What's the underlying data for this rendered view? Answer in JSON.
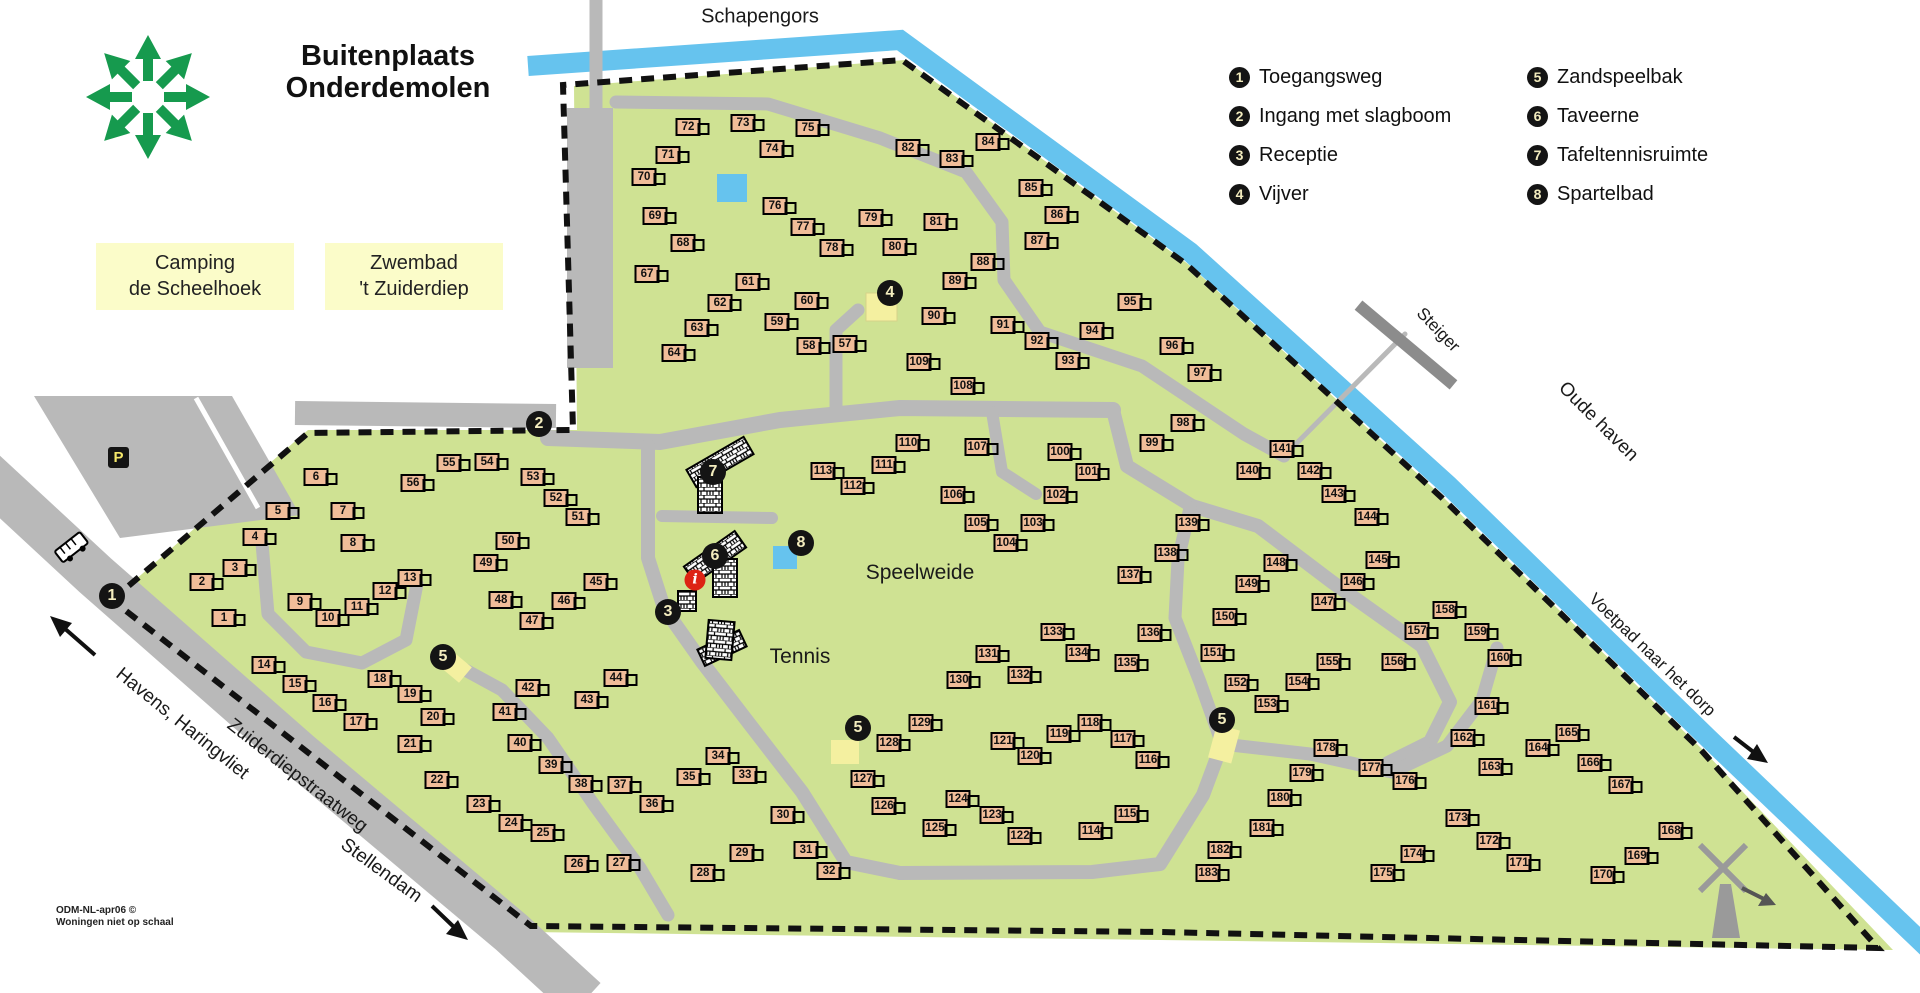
{
  "title": {
    "line1": "Buitenplaats",
    "line2": "Onderdemolen"
  },
  "top_label": "Schapengors",
  "boxes": {
    "camping": {
      "line1": "Camping",
      "line2": "de Scheelhoek"
    },
    "zwembad": {
      "line1": "Zwembad",
      "line2": "'t Zuiderdiep"
    }
  },
  "legend": {
    "columns": [
      [
        {
          "n": "1",
          "label": "Toegangsweg"
        },
        {
          "n": "2",
          "label": "Ingang met slagboom"
        },
        {
          "n": "3",
          "label": "Receptie"
        },
        {
          "n": "4",
          "label": "Vijver"
        }
      ],
      [
        {
          "n": "5",
          "label": "Zandspeelbak"
        },
        {
          "n": "6",
          "label": "Taveerne"
        },
        {
          "n": "7",
          "label": "Tafeltennisruimte"
        },
        {
          "n": "8",
          "label": "Spartelbad"
        }
      ]
    ]
  },
  "area_labels": {
    "speelweide": "Speelweide",
    "tennis": "Tennis",
    "steiger": "Steiger",
    "oude_haven": "Oude haven",
    "voetpad": "Voetpad naar het dorp",
    "havens": "Havens, Haringvliet",
    "zuiderdiep": "Zuiderdiepstraatweg",
    "stellendam": "Stellendam"
  },
  "parking_label": "P",
  "info_label": "i",
  "credits": {
    "line1": "ODM-NL-apr06 ©",
    "line2": "Woningen niet op schaal"
  },
  "colors": {
    "park_green": "#cfe293",
    "water_blue": "#66c3ee",
    "road_gray": "#b9b9b9",
    "house_fill": "#f0bd99",
    "facility_yellow": "#f4f0a0",
    "label_yellow": "#fbfcc9",
    "logo_green": "#169a4e",
    "marker_black": "#141414",
    "marker_text": "#f3ecbe",
    "info_red": "#dd2314"
  },
  "map_markers": [
    {
      "n": "1",
      "x": 112,
      "y": 596
    },
    {
      "n": "2",
      "x": 539,
      "y": 424
    },
    {
      "n": "3",
      "x": 668,
      "y": 612
    },
    {
      "n": "4",
      "x": 890,
      "y": 293
    },
    {
      "n": "5",
      "x": 443,
      "y": 657
    },
    {
      "n": "5",
      "x": 858,
      "y": 728
    },
    {
      "n": "5",
      "x": 1222,
      "y": 720
    },
    {
      "n": "6",
      "x": 715,
      "y": 556
    },
    {
      "n": "7",
      "x": 713,
      "y": 472
    },
    {
      "n": "8",
      "x": 801,
      "y": 543
    }
  ],
  "houses": [
    {
      "n": 1,
      "x": 224,
      "y": 618
    },
    {
      "n": 2,
      "x": 202,
      "y": 582
    },
    {
      "n": 3,
      "x": 235,
      "y": 568
    },
    {
      "n": 4,
      "x": 255,
      "y": 537
    },
    {
      "n": 5,
      "x": 278,
      "y": 511
    },
    {
      "n": 6,
      "x": 316,
      "y": 477
    },
    {
      "n": 7,
      "x": 343,
      "y": 511
    },
    {
      "n": 8,
      "x": 353,
      "y": 543
    },
    {
      "n": 9,
      "x": 300,
      "y": 602
    },
    {
      "n": 10,
      "x": 328,
      "y": 618
    },
    {
      "n": 11,
      "x": 357,
      "y": 607
    },
    {
      "n": 12,
      "x": 385,
      "y": 591
    },
    {
      "n": 13,
      "x": 410,
      "y": 578
    },
    {
      "n": 14,
      "x": 264,
      "y": 665
    },
    {
      "n": 15,
      "x": 295,
      "y": 684
    },
    {
      "n": 16,
      "x": 325,
      "y": 703
    },
    {
      "n": 17,
      "x": 356,
      "y": 722
    },
    {
      "n": 18,
      "x": 380,
      "y": 679
    },
    {
      "n": 19,
      "x": 410,
      "y": 694
    },
    {
      "n": 20,
      "x": 433,
      "y": 717
    },
    {
      "n": 21,
      "x": 410,
      "y": 744
    },
    {
      "n": 22,
      "x": 437,
      "y": 780
    },
    {
      "n": 23,
      "x": 479,
      "y": 804
    },
    {
      "n": 24,
      "x": 511,
      "y": 823
    },
    {
      "n": 25,
      "x": 543,
      "y": 833
    },
    {
      "n": 26,
      "x": 577,
      "y": 864
    },
    {
      "n": 27,
      "x": 619,
      "y": 863
    },
    {
      "n": 28,
      "x": 703,
      "y": 873
    },
    {
      "n": 29,
      "x": 742,
      "y": 853
    },
    {
      "n": 30,
      "x": 783,
      "y": 815
    },
    {
      "n": 31,
      "x": 806,
      "y": 850
    },
    {
      "n": 32,
      "x": 829,
      "y": 871
    },
    {
      "n": 33,
      "x": 745,
      "y": 775
    },
    {
      "n": 34,
      "x": 718,
      "y": 756
    },
    {
      "n": 35,
      "x": 689,
      "y": 777
    },
    {
      "n": 36,
      "x": 652,
      "y": 804
    },
    {
      "n": 37,
      "x": 620,
      "y": 785
    },
    {
      "n": 38,
      "x": 581,
      "y": 784
    },
    {
      "n": 39,
      "x": 551,
      "y": 765
    },
    {
      "n": 40,
      "x": 520,
      "y": 743
    },
    {
      "n": 41,
      "x": 505,
      "y": 712
    },
    {
      "n": 42,
      "x": 528,
      "y": 688
    },
    {
      "n": 43,
      "x": 587,
      "y": 700
    },
    {
      "n": 44,
      "x": 616,
      "y": 678
    },
    {
      "n": 45,
      "x": 596,
      "y": 582
    },
    {
      "n": 46,
      "x": 564,
      "y": 601
    },
    {
      "n": 47,
      "x": 532,
      "y": 621
    },
    {
      "n": 48,
      "x": 501,
      "y": 600
    },
    {
      "n": 49,
      "x": 486,
      "y": 563
    },
    {
      "n": 50,
      "x": 508,
      "y": 541
    },
    {
      "n": 51,
      "x": 578,
      "y": 517
    },
    {
      "n": 52,
      "x": 556,
      "y": 498
    },
    {
      "n": 53,
      "x": 533,
      "y": 477
    },
    {
      "n": 54,
      "x": 487,
      "y": 462
    },
    {
      "n": 55,
      "x": 449,
      "y": 463
    },
    {
      "n": 56,
      "x": 413,
      "y": 483
    },
    {
      "n": 57,
      "x": 845,
      "y": 344
    },
    {
      "n": 58,
      "x": 809,
      "y": 346
    },
    {
      "n": 59,
      "x": 777,
      "y": 322
    },
    {
      "n": 60,
      "x": 807,
      "y": 301
    },
    {
      "n": 61,
      "x": 748,
      "y": 282
    },
    {
      "n": 62,
      "x": 720,
      "y": 303
    },
    {
      "n": 63,
      "x": 697,
      "y": 328
    },
    {
      "n": 64,
      "x": 674,
      "y": 353
    },
    {
      "n": 67,
      "x": 647,
      "y": 274
    },
    {
      "n": 68,
      "x": 683,
      "y": 243
    },
    {
      "n": 69,
      "x": 655,
      "y": 216
    },
    {
      "n": 70,
      "x": 644,
      "y": 177
    },
    {
      "n": 71,
      "x": 668,
      "y": 155
    },
    {
      "n": 72,
      "x": 688,
      "y": 127
    },
    {
      "n": 73,
      "x": 743,
      "y": 123
    },
    {
      "n": 74,
      "x": 772,
      "y": 149
    },
    {
      "n": 75,
      "x": 808,
      "y": 128
    },
    {
      "n": 76,
      "x": 775,
      "y": 206
    },
    {
      "n": 77,
      "x": 803,
      "y": 227
    },
    {
      "n": 78,
      "x": 832,
      "y": 248
    },
    {
      "n": 79,
      "x": 871,
      "y": 218
    },
    {
      "n": 80,
      "x": 895,
      "y": 247
    },
    {
      "n": 81,
      "x": 936,
      "y": 222
    },
    {
      "n": 82,
      "x": 908,
      "y": 148
    },
    {
      "n": 83,
      "x": 952,
      "y": 159
    },
    {
      "n": 84,
      "x": 988,
      "y": 142
    },
    {
      "n": 85,
      "x": 1031,
      "y": 188
    },
    {
      "n": 86,
      "x": 1057,
      "y": 215
    },
    {
      "n": 87,
      "x": 1037,
      "y": 241
    },
    {
      "n": 88,
      "x": 983,
      "y": 262
    },
    {
      "n": 89,
      "x": 955,
      "y": 281
    },
    {
      "n": 90,
      "x": 934,
      "y": 316
    },
    {
      "n": 91,
      "x": 1003,
      "y": 325
    },
    {
      "n": 92,
      "x": 1037,
      "y": 341
    },
    {
      "n": 93,
      "x": 1068,
      "y": 361
    },
    {
      "n": 94,
      "x": 1092,
      "y": 331
    },
    {
      "n": 95,
      "x": 1130,
      "y": 302
    },
    {
      "n": 96,
      "x": 1172,
      "y": 346
    },
    {
      "n": 97,
      "x": 1200,
      "y": 373
    },
    {
      "n": 98,
      "x": 1183,
      "y": 423
    },
    {
      "n": 99,
      "x": 1152,
      "y": 443
    },
    {
      "n": 100,
      "x": 1060,
      "y": 452
    },
    {
      "n": 101,
      "x": 1088,
      "y": 472
    },
    {
      "n": 102,
      "x": 1056,
      "y": 495
    },
    {
      "n": 103,
      "x": 1033,
      "y": 523
    },
    {
      "n": 104,
      "x": 1006,
      "y": 543
    },
    {
      "n": 105,
      "x": 977,
      "y": 523
    },
    {
      "n": 106,
      "x": 953,
      "y": 495
    },
    {
      "n": 107,
      "x": 977,
      "y": 447
    },
    {
      "n": 108,
      "x": 963,
      "y": 386
    },
    {
      "n": 109,
      "x": 919,
      "y": 362
    },
    {
      "n": 110,
      "x": 908,
      "y": 443
    },
    {
      "n": 111,
      "x": 884,
      "y": 465
    },
    {
      "n": 112,
      "x": 853,
      "y": 486
    },
    {
      "n": 113,
      "x": 823,
      "y": 471
    },
    {
      "n": 114,
      "x": 1091,
      "y": 831
    },
    {
      "n": 115,
      "x": 1127,
      "y": 814
    },
    {
      "n": 116,
      "x": 1148,
      "y": 760
    },
    {
      "n": 117,
      "x": 1123,
      "y": 739
    },
    {
      "n": 118,
      "x": 1090,
      "y": 723
    },
    {
      "n": 119,
      "x": 1059,
      "y": 734
    },
    {
      "n": 120,
      "x": 1030,
      "y": 756
    },
    {
      "n": 121,
      "x": 1003,
      "y": 741
    },
    {
      "n": 122,
      "x": 1020,
      "y": 836
    },
    {
      "n": 123,
      "x": 992,
      "y": 815
    },
    {
      "n": 124,
      "x": 958,
      "y": 799
    },
    {
      "n": 125,
      "x": 935,
      "y": 828
    },
    {
      "n": 126,
      "x": 884,
      "y": 806
    },
    {
      "n": 127,
      "x": 863,
      "y": 779
    },
    {
      "n": 128,
      "x": 889,
      "y": 743
    },
    {
      "n": 129,
      "x": 921,
      "y": 723
    },
    {
      "n": 130,
      "x": 959,
      "y": 680
    },
    {
      "n": 131,
      "x": 988,
      "y": 654
    },
    {
      "n": 132,
      "x": 1020,
      "y": 675
    },
    {
      "n": 133,
      "x": 1053,
      "y": 632
    },
    {
      "n": 134,
      "x": 1078,
      "y": 653
    },
    {
      "n": 135,
      "x": 1127,
      "y": 663
    },
    {
      "n": 136,
      "x": 1150,
      "y": 633
    },
    {
      "n": 137,
      "x": 1130,
      "y": 575
    },
    {
      "n": 138,
      "x": 1167,
      "y": 553
    },
    {
      "n": 139,
      "x": 1188,
      "y": 523
    },
    {
      "n": 140,
      "x": 1249,
      "y": 471
    },
    {
      "n": 141,
      "x": 1282,
      "y": 449
    },
    {
      "n": 142,
      "x": 1310,
      "y": 471
    },
    {
      "n": 143,
      "x": 1334,
      "y": 494
    },
    {
      "n": 144,
      "x": 1367,
      "y": 517
    },
    {
      "n": 145,
      "x": 1378,
      "y": 560
    },
    {
      "n": 146,
      "x": 1353,
      "y": 582
    },
    {
      "n": 147,
      "x": 1324,
      "y": 602
    },
    {
      "n": 148,
      "x": 1276,
      "y": 563
    },
    {
      "n": 149,
      "x": 1248,
      "y": 584
    },
    {
      "n": 150,
      "x": 1225,
      "y": 617
    },
    {
      "n": 151,
      "x": 1213,
      "y": 653
    },
    {
      "n": 152,
      "x": 1237,
      "y": 683
    },
    {
      "n": 153,
      "x": 1267,
      "y": 704
    },
    {
      "n": 154,
      "x": 1298,
      "y": 682
    },
    {
      "n": 155,
      "x": 1329,
      "y": 662
    },
    {
      "n": 156,
      "x": 1394,
      "y": 662
    },
    {
      "n": 157,
      "x": 1417,
      "y": 631
    },
    {
      "n": 158,
      "x": 1445,
      "y": 610
    },
    {
      "n": 159,
      "x": 1477,
      "y": 632
    },
    {
      "n": 160,
      "x": 1500,
      "y": 658
    },
    {
      "n": 161,
      "x": 1487,
      "y": 706
    },
    {
      "n": 162,
      "x": 1463,
      "y": 738
    },
    {
      "n": 163,
      "x": 1491,
      "y": 767
    },
    {
      "n": 164,
      "x": 1538,
      "y": 748
    },
    {
      "n": 165,
      "x": 1568,
      "y": 733
    },
    {
      "n": 166,
      "x": 1590,
      "y": 763
    },
    {
      "n": 167,
      "x": 1621,
      "y": 785
    },
    {
      "n": 168,
      "x": 1671,
      "y": 831
    },
    {
      "n": 169,
      "x": 1637,
      "y": 856
    },
    {
      "n": 170,
      "x": 1603,
      "y": 875
    },
    {
      "n": 171,
      "x": 1519,
      "y": 863
    },
    {
      "n": 172,
      "x": 1489,
      "y": 841
    },
    {
      "n": 173,
      "x": 1458,
      "y": 818
    },
    {
      "n": 174,
      "x": 1413,
      "y": 854
    },
    {
      "n": 175,
      "x": 1383,
      "y": 873
    },
    {
      "n": 176,
      "x": 1405,
      "y": 781
    },
    {
      "n": 177,
      "x": 1371,
      "y": 768
    },
    {
      "n": 178,
      "x": 1326,
      "y": 748
    },
    {
      "n": 179,
      "x": 1302,
      "y": 773
    },
    {
      "n": 180,
      "x": 1280,
      "y": 798
    },
    {
      "n": 181,
      "x": 1262,
      "y": 828
    },
    {
      "n": 182,
      "x": 1220,
      "y": 850
    },
    {
      "n": 183,
      "x": 1208,
      "y": 873
    }
  ]
}
